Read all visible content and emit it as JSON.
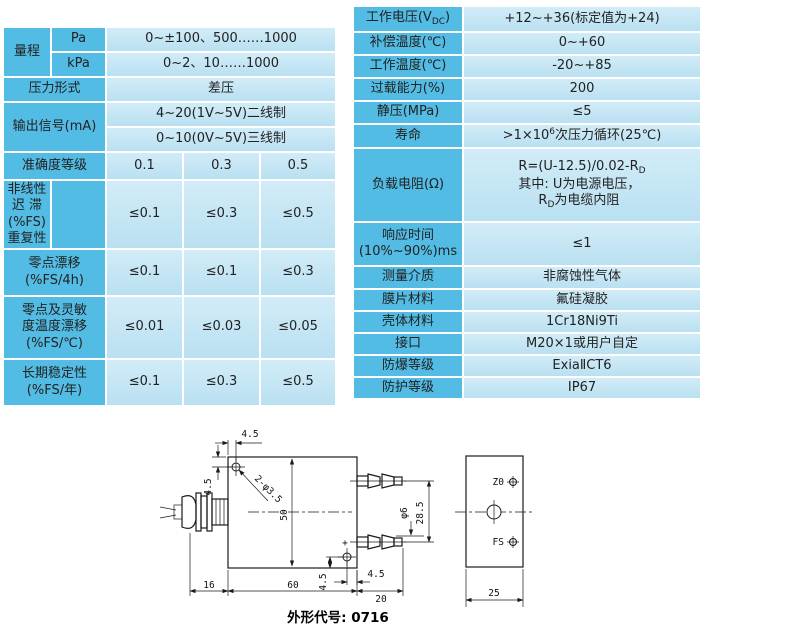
{
  "colors": {
    "label_cell": "#53bce4",
    "value_cell_top": "#d2ecf8",
    "value_cell_bottom": "#b9e0f1",
    "text": "#222222",
    "line": "#1a1a1a"
  },
  "left_table": {
    "rows": [
      {
        "label": "量程",
        "sub": "Pa",
        "value": "0~±100、500……1000"
      },
      {
        "sub": "kPa",
        "value": "0~2、10……1000"
      },
      {
        "label": "压力形式",
        "value": "差压"
      },
      {
        "label": "输出信号(mA)",
        "value": "4~20(1V~5V)二线制"
      },
      {
        "value": "0~10(0V~5V)三线制"
      },
      {
        "label": "准确度等级",
        "v1": "0.1",
        "v2": "0.3",
        "v3": "0.5"
      },
      {
        "label_lines": [
          "非线性",
          "迟  滞(%FS)",
          "重复性"
        ],
        "v1": "≤0.1",
        "v2": "≤0.3",
        "v3": "≤0.5"
      },
      {
        "label_lines": [
          "零点漂移",
          "(%FS/4h)"
        ],
        "v1": "≤0.1",
        "v2": "≤0.1",
        "v3": "≤0.3"
      },
      {
        "label_lines": [
          "零点及灵敏",
          "度温度漂移",
          "(%FS/℃)"
        ],
        "v1": "≤0.01",
        "v2": "≤0.03",
        "v3": "≤0.05"
      },
      {
        "label_lines": [
          "长期稳定性",
          "(%FS/年)"
        ],
        "v1": "≤0.1",
        "v2": "≤0.3",
        "v3": "≤0.5"
      }
    ]
  },
  "right_table": {
    "rows": [
      {
        "label_pre": "工作电压(V",
        "label_sub": "DC",
        "label_post": ")",
        "value": "+12~+36(标定值为+24)"
      },
      {
        "label": "补偿温度(℃)",
        "value": "0~+60"
      },
      {
        "label": "工作温度(℃)",
        "value": "-20~+85"
      },
      {
        "label": "过载能力(%)",
        "value": "200"
      },
      {
        "label": "静压(MPa)",
        "value": "≤5"
      },
      {
        "label": "寿命",
        "value_pre": ">1×10",
        "value_sup": "6",
        "value_post": "次压力循环(25℃)"
      },
      {
        "label": "负载电阻(Ω)",
        "line1_pre": "R=(U-12.5)/0.02-R",
        "line1_sub": "D",
        "line2": "其中: U为电源电压，",
        "line3_pre": "R",
        "line3_sub": "D",
        "line3_post": "为电缆内阻"
      },
      {
        "label_lines": [
          "响应时间",
          "(10%~90%)ms"
        ],
        "value": "≤1"
      },
      {
        "label": "测量介质",
        "value": "非腐蚀性气体"
      },
      {
        "label": "膜片材料",
        "value": "氟硅凝胶"
      },
      {
        "label": "壳体材料",
        "value": "1Cr18Ni9Ti"
      },
      {
        "label": "接口",
        "value": "M20×1或用户自定"
      },
      {
        "label": "防爆等级",
        "value": "ExiaⅡCT6"
      },
      {
        "label": "防护等级",
        "value": "IP67"
      }
    ]
  },
  "drawing": {
    "dims": {
      "hole_offset_top": "4.5",
      "hole_offset_left": "4.5",
      "mounting_holes": "2-φ3.5",
      "body_height": "50",
      "port_diameter": "φ6",
      "port_spacing": "28.5",
      "hole_offset_bottom": "4.5",
      "hole_offset_right": "4.5",
      "gland_length": "16",
      "body_width": "60",
      "port_length": "20",
      "side_width": "25"
    },
    "labels": {
      "zero": "Z0",
      "fullscale": "FS",
      "plus": "+"
    },
    "caption": "外形代号: 0716"
  }
}
